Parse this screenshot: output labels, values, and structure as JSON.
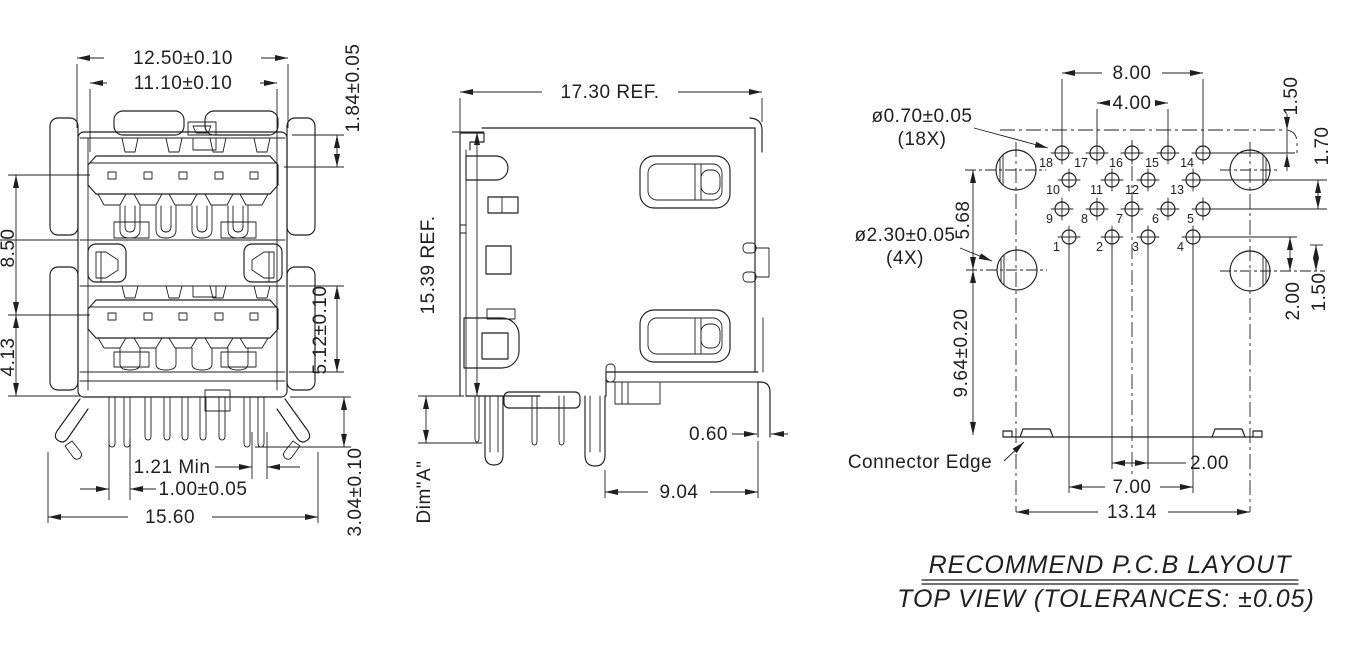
{
  "front_view": {
    "dim_outer_width": "12.50±0.10",
    "dim_inner_width": "11.10±0.10",
    "dim_tongue_offset": "1.84±0.05",
    "dim_port_span": "8.50",
    "dim_lower_span": "4.13",
    "dim_lower_port_height": "5.12±0.10",
    "dim_pin_gap": "1.21 Min",
    "dim_pin_width": "1.00±0.05",
    "dim_overall_width": "15.60",
    "dim_pin_length": "3.04±0.10"
  },
  "side_view": {
    "dim_depth": "17.30 REF.",
    "dim_height": "15.39 REF.",
    "dim_a_label": "Dim\"A\"",
    "dim_edge_gap": "0.60",
    "dim_leg_span": "9.04"
  },
  "pcb_layout": {
    "callout_small_hole": "ø0.70±0.05",
    "callout_small_hole_qty": "(18X)",
    "callout_large_hole": "ø2.30±0.05",
    "callout_large_hole_qty": "(4X)",
    "label_connector_edge": "Connector Edge",
    "dim_row_width": "8.00",
    "dim_row_inner": "4.00",
    "dim_edge_to_row": "1.50",
    "dim_row_gap": "1.70",
    "dim_hole_offset": "2.00",
    "dim_hole_offset2": "1.50",
    "dim_hole_pitch_v": "5.68",
    "dim_hole_to_edge": "9.64±0.20",
    "dim_pin_center": "2.00",
    "dim_pin_outer": "7.00",
    "dim_hole_pitch_h": "13.14",
    "pin_rows": [
      {
        "labels": [
          "18",
          "17",
          "16",
          "15",
          "14"
        ]
      },
      {
        "labels": [
          "10",
          "11",
          "12",
          "13"
        ]
      },
      {
        "labels": [
          "9",
          "8",
          "7",
          "6",
          "5"
        ]
      },
      {
        "labels": [
          "1",
          "2",
          "3",
          "4"
        ]
      }
    ]
  },
  "title_block": {
    "line1": "RECOMMEND P.C.B LAYOUT",
    "line2": "TOP VIEW (TOLERANCES: ±0.05)"
  }
}
